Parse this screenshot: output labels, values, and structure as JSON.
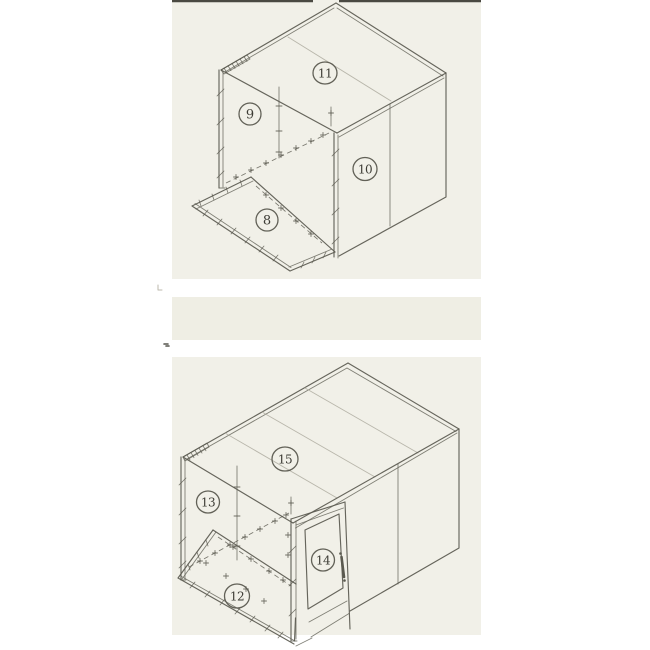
{
  "colors": {
    "page": "#ffffff",
    "paper": "#f1f0e8",
    "paper_mid": "#efeee4",
    "line": "#5a594f",
    "faint_line": "#aaa89b",
    "label_ink": "#3c3b34",
    "top_rule": "#4a4942"
  },
  "diagrams": [
    {
      "name": "top-assembly",
      "labels": [
        {
          "text": "8"
        },
        {
          "text": "9"
        },
        {
          "text": "10"
        },
        {
          "text": "11"
        }
      ]
    },
    {
      "name": "bottom-assembly",
      "labels": [
        {
          "text": "12"
        },
        {
          "text": "13"
        },
        {
          "text": "14"
        },
        {
          "text": "15"
        }
      ]
    }
  ]
}
